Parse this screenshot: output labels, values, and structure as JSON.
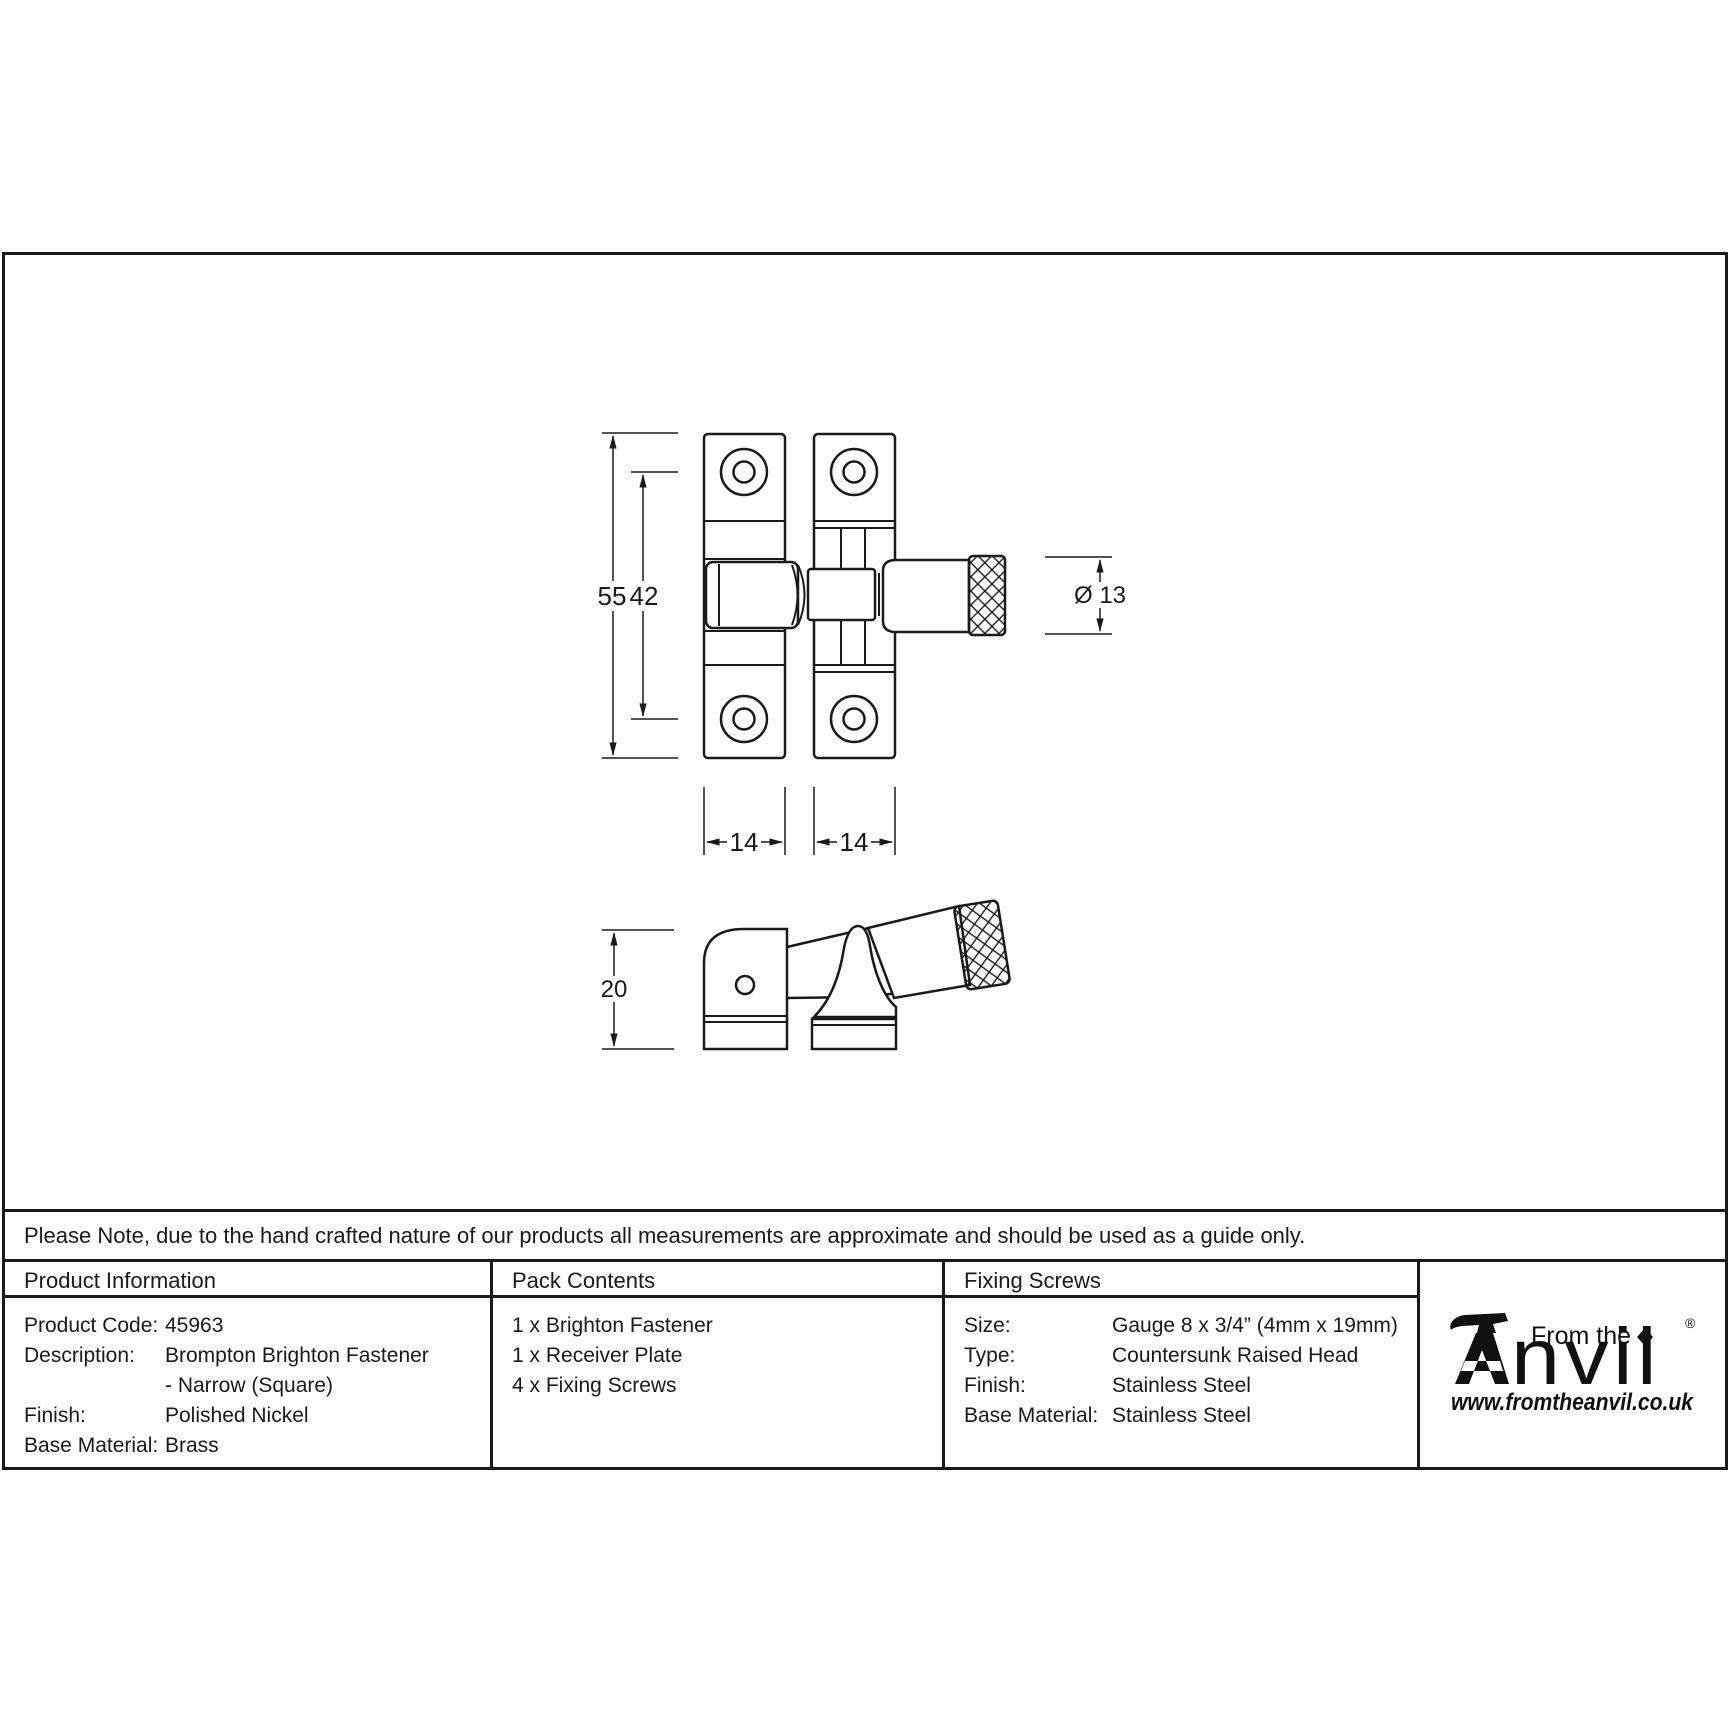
{
  "drawing": {
    "dimensions": {
      "total_height": "55",
      "hole_spacing": "42",
      "left_plate_width": "14",
      "right_plate_width": "14",
      "knob_diameter": "Ø 13",
      "side_height": "20"
    }
  },
  "note": "Please Note, due to the hand crafted nature of our products all measurements are approximate and should be used as a guide only.",
  "table": {
    "product_information": {
      "header": "Product Information",
      "rows": [
        {
          "label": "Product Code:",
          "value": "45963"
        },
        {
          "label": "Description:",
          "value": "Brompton Brighton Fastener"
        },
        {
          "label": "",
          "value": "- Narrow (Square)"
        },
        {
          "label": "Finish:",
          "value": "Polished Nickel"
        },
        {
          "label": "Base Material:",
          "value": "Brass"
        }
      ]
    },
    "pack_contents": {
      "header": "Pack Contents",
      "items": [
        "1 x Brighton Fastener",
        "1 x Receiver Plate",
        "4 x Fixing Screws"
      ]
    },
    "fixing_screws": {
      "header": "Fixing Screws",
      "rows": [
        {
          "label": "Size:",
          "value": "Gauge 8 x 3/4” (4mm x 19mm)"
        },
        {
          "label": "Type:",
          "value": "Countersunk Raised Head"
        },
        {
          "label": "Finish:",
          "value": "Stainless Steel"
        },
        {
          "label": "Base Material:",
          "value": "Stainless Steel"
        }
      ]
    }
  },
  "logo": {
    "from_the": "From the",
    "anvil_text": "nvil",
    "registered": "®",
    "url": "www.fromtheanvil.co.uk"
  }
}
